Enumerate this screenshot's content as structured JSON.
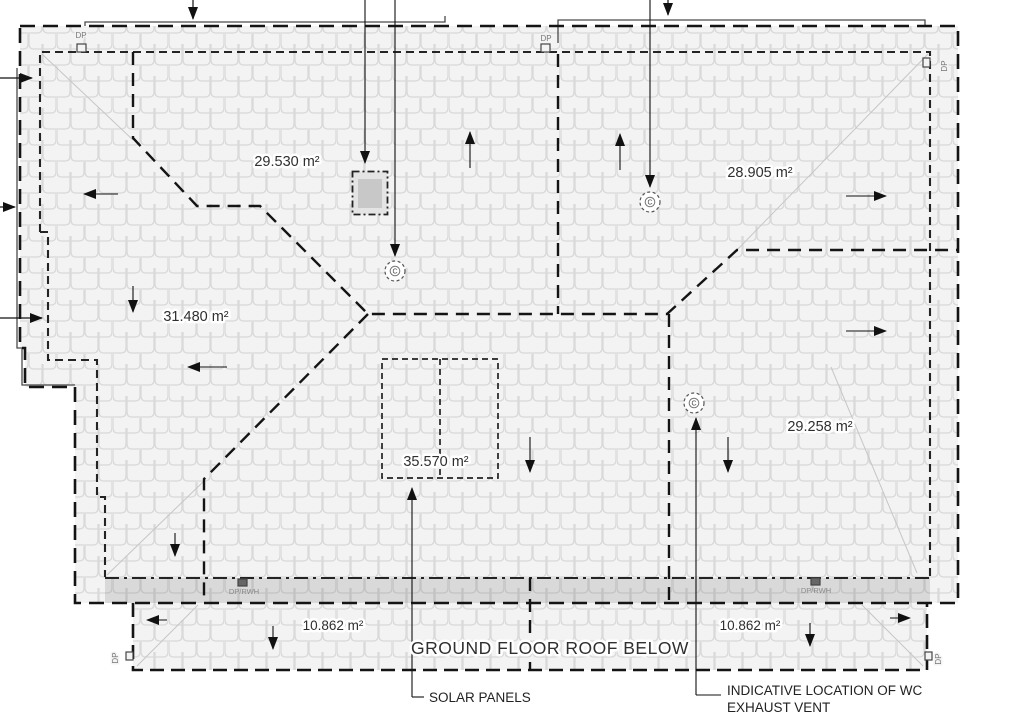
{
  "areas": [
    {
      "name": "upper-left-roof-plane",
      "label": "29.530 m²"
    },
    {
      "name": "upper-right-roof-plane",
      "label": "28.905 m²"
    },
    {
      "name": "left-wing-roof-plane",
      "label": "31.480 m²"
    },
    {
      "name": "solar-roof-plane",
      "label": "35.570 m²"
    },
    {
      "name": "right-roof-plane",
      "label": "29.258 m²"
    },
    {
      "name": "lower-left-roof-plane",
      "label": "10.862 m²"
    },
    {
      "name": "lower-right-roof-plane",
      "label": "10.862 m²"
    }
  ],
  "labels": {
    "ground_floor": "GROUND FLOOR ROOF BELOW",
    "solar_panels": "SOLAR PANELS",
    "wc_line1": "INDICATIVE LOCATION OF WC",
    "wc_line2": "EXHAUST VENT"
  },
  "marks": {
    "dp": "DP",
    "dp_rwh": "DP/RWH",
    "vent": "C"
  },
  "colors": {
    "line": "#1a1a1a",
    "tile_fill": "#f3f3f3",
    "tile_stroke": "#dadada",
    "band_fill": "#d8d8d8",
    "skylight_fill": "#c8c8c8",
    "label_text": "#2f2f2f"
  }
}
